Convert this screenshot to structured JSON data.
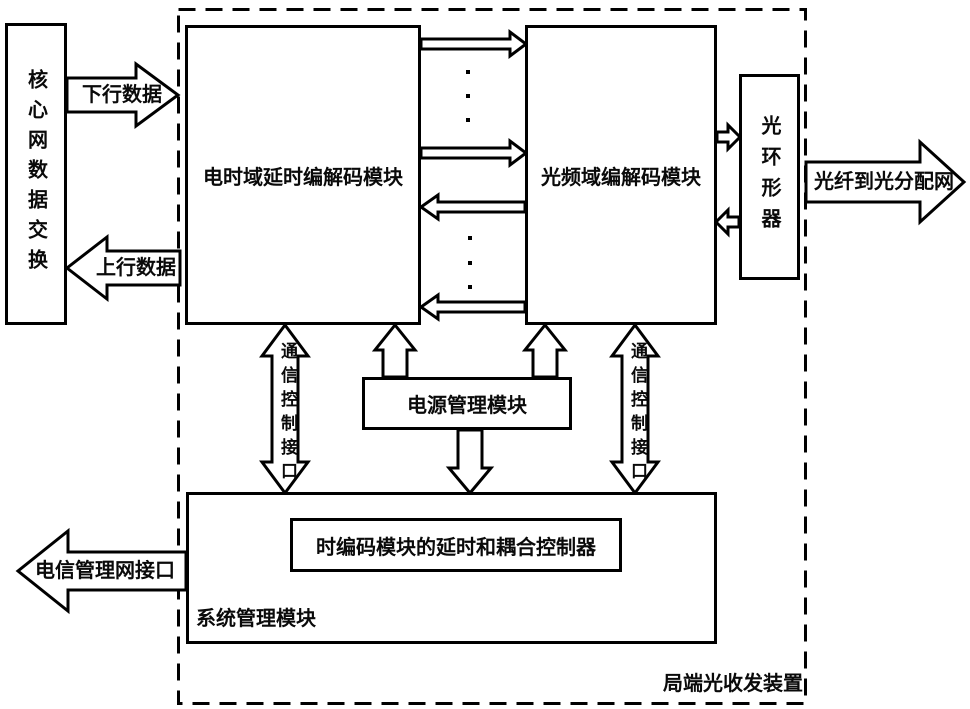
{
  "diagram": {
    "external": {
      "core_switch_label": "核心网数据交换",
      "downlink_label": "下行数据",
      "uplink_label": "上行数据",
      "tmn_label": "电信管理网接口",
      "odn_label": "光纤到光分配网"
    },
    "device": {
      "boundary_label": "局端光收发装置",
      "electrical_codec_label": "电时域延时编解码模块",
      "optical_codec_label": "光频域编解码模块",
      "circulator_label": "光环形器",
      "power_label": "电源管理模块",
      "system_label": "系统管理模块",
      "controller_label": "时编码模块的延时和耦合控制器",
      "comm_interface_label": "通信控制接口"
    },
    "colors": {
      "line": "#000000",
      "background": "#ffffff"
    }
  }
}
